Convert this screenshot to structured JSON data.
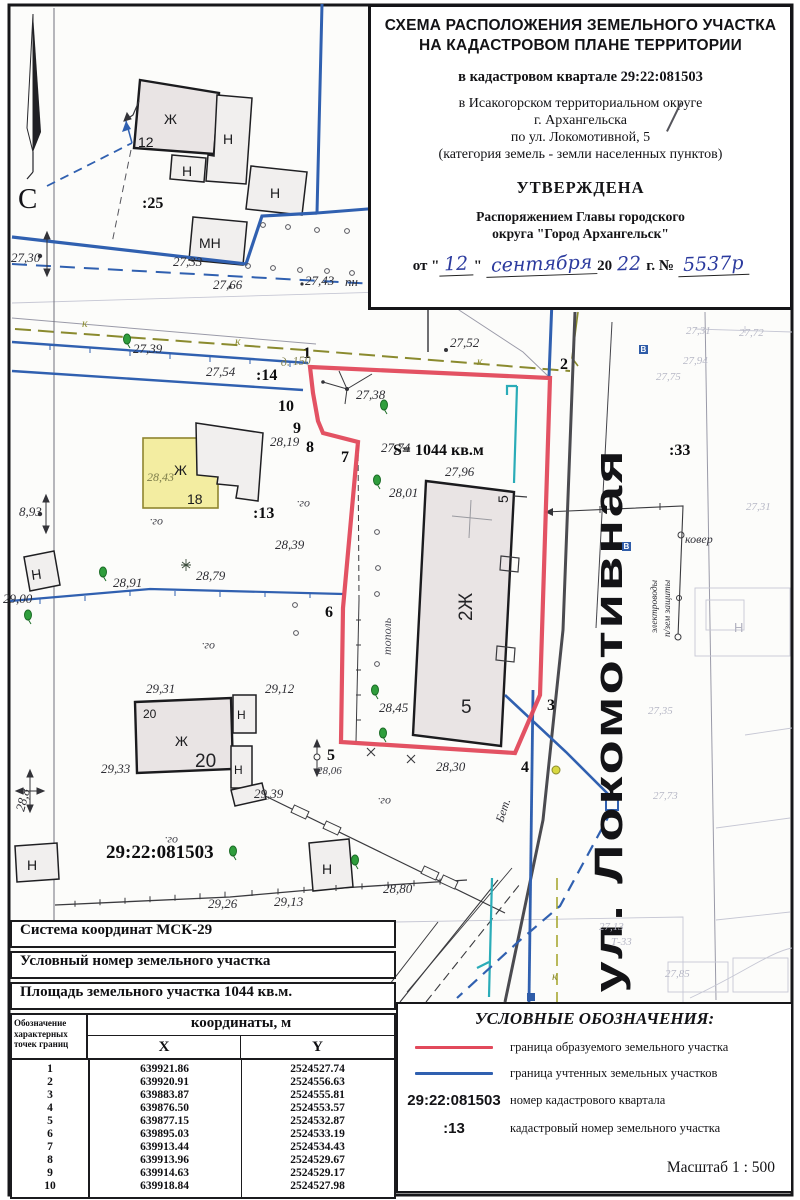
{
  "title_block": {
    "line1": "СХЕМА РАСПОЛОЖЕНИЯ ЗЕМЕЛЬНОГО УЧАСТКА",
    "line2": "НА КАДАСТРОВОМ ПЛАНЕ ТЕРРИТОРИИ",
    "quarter": "в кадастровом квартале 29:22:081503",
    "okrug": "в Исакогорском территориальном округе",
    "city": "г. Архангельска",
    "street": "по ул. Локомотивной, 5",
    "category": "(категория земель - земли населенных пунктов)",
    "approved": "УТВЕРЖДЕНА",
    "order1": "Распоряжением Главы городского",
    "order2": "округа \"Город Архангельск\"",
    "date_prefix": "от \"",
    "date_day": "12",
    "date_quote": "\"",
    "date_month": "сентября",
    "date_year_prefix": "20",
    "date_year": "22",
    "date_suffix": "г. №",
    "doc_number": "5537р"
  },
  "table": {
    "row1": "Система координат МСК-29",
    "row2": "Условный номер земельного участка",
    "row3": "Площадь земельного участка  1044 кв.м.",
    "col_point": "Обозначение характерных точек границ",
    "col_coords": "координаты, м",
    "col_x": "X",
    "col_y": "Y",
    "rows": [
      {
        "n": "1",
        "x": "639921.86",
        "y": "2524527.74"
      },
      {
        "n": "2",
        "x": "639920.91",
        "y": "2524556.63"
      },
      {
        "n": "3",
        "x": "639883.87",
        "y": "2524555.81"
      },
      {
        "n": "4",
        "x": "639876.50",
        "y": "2524553.57"
      },
      {
        "n": "5",
        "x": "639877.15",
        "y": "2524532.87"
      },
      {
        "n": "6",
        "x": "639895.03",
        "y": "2524533.19"
      },
      {
        "n": "7",
        "x": "639913.44",
        "y": "2524534.43"
      },
      {
        "n": "8",
        "x": "639913.96",
        "y": "2524529.67"
      },
      {
        "n": "9",
        "x": "639914.63",
        "y": "2524529.17"
      },
      {
        "n": "10",
        "x": "639918.84",
        "y": "2524527.98"
      }
    ]
  },
  "legend": {
    "title": "УСЛОВНЫЕ ОБОЗНАЧЕНИЯ:",
    "items": [
      {
        "symbol_type": "line",
        "color": "#e2495b",
        "label": "граница образуемого земельного участка"
      },
      {
        "symbol_type": "line",
        "color": "#3060b0",
        "label": "граница учтенных земельных участков"
      },
      {
        "symbol_type": "text",
        "symbol": "29:22:081503",
        "label": "номер кадастрового квартала"
      },
      {
        "symbol_type": "text",
        "symbol": ":13",
        "label": "кадастровый номер земельного участка"
      }
    ],
    "scale": "Масштаб  1 : 500"
  },
  "map": {
    "street_name": "ул. Локомотивная",
    "colors": {
      "boundary_new": "#e2495b",
      "boundary_existing": "#3060b0"
    },
    "labels": [
      {
        "t": "27,30",
        "x": 11,
        "y": 262,
        "c": "elev"
      },
      {
        "t": "27,33",
        "x": 173,
        "y": 266,
        "c": "elev"
      },
      {
        "t": "27,66",
        "x": 213,
        "y": 289,
        "c": "elev"
      },
      {
        "t": "27,43",
        "x": 305,
        "y": 285,
        "c": "elev"
      },
      {
        "t": "пн",
        "x": 345,
        "y": 286,
        "c": "elev"
      },
      {
        "t": "27,39",
        "x": 133,
        "y": 353,
        "c": "elev"
      },
      {
        "t": "27,54",
        "x": 206,
        "y": 376,
        "c": "elev"
      },
      {
        "t": "27,52",
        "x": 450,
        "y": 347,
        "c": "elev"
      },
      {
        "t": "27,38",
        "x": 356,
        "y": 399,
        "c": "elev"
      },
      {
        "t": "27,74",
        "x": 381,
        "y": 452,
        "c": "elev"
      },
      {
        "t": "28,01",
        "x": 389,
        "y": 497,
        "c": "elev"
      },
      {
        "t": "27,96",
        "x": 445,
        "y": 476,
        "c": "elev"
      },
      {
        "t": "28,45",
        "x": 379,
        "y": 712,
        "c": "elev"
      },
      {
        "t": "28,30",
        "x": 436,
        "y": 771,
        "c": "elev"
      },
      {
        "t": "28,19",
        "x": 270,
        "y": 446,
        "c": "elev"
      },
      {
        "t": "28,39",
        "x": 275,
        "y": 549,
        "c": "elev"
      },
      {
        "t": "28,91",
        "x": 113,
        "y": 587,
        "c": "elev"
      },
      {
        "t": "28,79",
        "x": 196,
        "y": 580,
        "c": "elev"
      },
      {
        "t": "29,00",
        "x": 3,
        "y": 603,
        "c": "elev"
      },
      {
        "t": "8,93",
        "x": 19,
        "y": 516,
        "c": "elev"
      },
      {
        "t": "29,31",
        "x": 146,
        "y": 693,
        "c": "elev"
      },
      {
        "t": "29,12",
        "x": 265,
        "y": 693,
        "c": "elev"
      },
      {
        "t": "29,33",
        "x": 101,
        "y": 773,
        "c": "elev"
      },
      {
        "t": "29,39",
        "x": 254,
        "y": 798,
        "c": "elev"
      },
      {
        "t": "29,26",
        "x": 208,
        "y": 908,
        "c": "elev"
      },
      {
        "t": "29,13",
        "x": 274,
        "y": 906,
        "c": "elev"
      },
      {
        "t": "28,80",
        "x": 383,
        "y": 893,
        "c": "elev"
      },
      {
        "t": "28,06",
        "x": 317,
        "y": 774,
        "c": "elev-sm"
      },
      {
        "t": "28,8",
        "x": 24,
        "y": 812,
        "c": "elev",
        "r": -75
      },
      {
        "t": "1",
        "x": 303,
        "y": 358,
        "c": "bold"
      },
      {
        "t": "2",
        "x": 560,
        "y": 369,
        "c": "bold"
      },
      {
        "t": "3",
        "x": 547,
        "y": 710,
        "c": "bold"
      },
      {
        "t": "4",
        "x": 521,
        "y": 772,
        "c": "bold"
      },
      {
        "t": "5",
        "x": 327,
        "y": 760,
        "c": "bold"
      },
      {
        "t": "6",
        "x": 325,
        "y": 617,
        "c": "bold"
      },
      {
        "t": "7",
        "x": 341,
        "y": 462,
        "c": "bold"
      },
      {
        "t": "8",
        "x": 306,
        "y": 452,
        "c": "bold"
      },
      {
        "t": "9",
        "x": 293,
        "y": 433,
        "c": "bold"
      },
      {
        "t": "10",
        "x": 278,
        "y": 411,
        "c": "bold"
      },
      {
        "t": ":25",
        "x": 142,
        "y": 208,
        "c": "bold"
      },
      {
        "t": ":14",
        "x": 256,
        "y": 380,
        "c": "bold"
      },
      {
        "t": ":13",
        "x": 253,
        "y": 518,
        "c": "bold"
      },
      {
        "t": ":33",
        "x": 669,
        "y": 455,
        "c": "bold"
      },
      {
        "t": "S= 1044 кв.м",
        "x": 393,
        "y": 455,
        "c": "bold"
      },
      {
        "t": "29:22:081503",
        "x": 106,
        "y": 858,
        "c": "bold-lg"
      },
      {
        "t": "Ж",
        "x": 164,
        "y": 124,
        "c": "bld"
      },
      {
        "t": "12",
        "x": 138,
        "y": 147,
        "c": "bld"
      },
      {
        "t": "Н",
        "x": 223,
        "y": 144,
        "c": "bld"
      },
      {
        "t": "Н",
        "x": 182,
        "y": 176,
        "c": "bld"
      },
      {
        "t": "Н",
        "x": 270,
        "y": 198,
        "c": "bld"
      },
      {
        "t": "МН",
        "x": 199,
        "y": 248,
        "c": "bld"
      },
      {
        "t": "Ж",
        "x": 174,
        "y": 475,
        "c": "bld"
      },
      {
        "t": "18",
        "x": 187,
        "y": 504,
        "c": "bld"
      },
      {
        "t": "Н",
        "x": 32,
        "y": 580,
        "c": "bld",
        "r": -8
      },
      {
        "t": "Ж",
        "x": 175,
        "y": 746,
        "c": "bld"
      },
      {
        "t": "20",
        "x": 143,
        "y": 718,
        "c": "bld-sm"
      },
      {
        "t": "20",
        "x": 195,
        "y": 767,
        "c": "bld-lg"
      },
      {
        "t": "Н",
        "x": 237,
        "y": 719,
        "c": "bld-sm"
      },
      {
        "t": "Н",
        "x": 234,
        "y": 774,
        "c": "bld-sm"
      },
      {
        "t": "Н",
        "x": 322,
        "y": 874,
        "c": "bld"
      },
      {
        "t": "Н",
        "x": 27,
        "y": 870,
        "c": "bld"
      },
      {
        "t": "Н",
        "x": 734,
        "y": 632,
        "c": "bld-faint"
      },
      {
        "t": "2Ж",
        "x": 472,
        "y": 621,
        "c": "bld-lg",
        "r": -90
      },
      {
        "t": "5",
        "x": 461,
        "y": 713,
        "c": "bld-lg"
      },
      {
        "t": "5",
        "x": 508,
        "y": 503,
        "c": "bld",
        "r": -90
      },
      {
        "t": "28,43",
        "x": 147,
        "y": 481,
        "c": "hand"
      },
      {
        "t": "д. 150",
        "x": 281,
        "y": 366,
        "c": "hand",
        "r": -4
      },
      {
        "t": "ог.",
        "x": 163,
        "y": 519,
        "c": "og",
        "r": 180
      },
      {
        "t": "ог.",
        "x": 215,
        "y": 643,
        "c": "og",
        "r": 180
      },
      {
        "t": "ог.",
        "x": 310,
        "y": 501,
        "c": "og",
        "r": 180
      },
      {
        "t": "ог.",
        "x": 178,
        "y": 837,
        "c": "og",
        "r": 180
      },
      {
        "t": "ог.",
        "x": 391,
        "y": 798,
        "c": "og",
        "r": 180
      },
      {
        "t": "к",
        "x": 82,
        "y": 327,
        "c": "k"
      },
      {
        "t": "к",
        "x": 235,
        "y": 345,
        "c": "k"
      },
      {
        "t": "к",
        "x": 477,
        "y": 365,
        "c": "k"
      },
      {
        "t": "к",
        "x": 552,
        "y": 980,
        "c": "k"
      },
      {
        "t": "ковер",
        "x": 685,
        "y": 543,
        "c": "tech"
      },
      {
        "t": "Бет.",
        "x": 503,
        "y": 823,
        "c": "tech",
        "r": -72
      },
      {
        "t": "тополь",
        "x": 391,
        "y": 655,
        "c": "top",
        "r": -90
      },
      {
        "t": "электроводы",
        "x": 657,
        "y": 633,
        "c": "tech-sm",
        "r": -90
      },
      {
        "t": "п/зем защиты",
        "x": 670,
        "y": 637,
        "c": "tech-sm",
        "r": -90
      },
      {
        "t": "27,31",
        "x": 686,
        "y": 334,
        "c": "faint"
      },
      {
        "t": "27,72",
        "x": 739,
        "y": 336,
        "c": "faint"
      },
      {
        "t": "27,94",
        "x": 683,
        "y": 364,
        "c": "faint"
      },
      {
        "t": "27,75",
        "x": 656,
        "y": 380,
        "c": "faint"
      },
      {
        "t": "27,35",
        "x": 648,
        "y": 714,
        "c": "faint"
      },
      {
        "t": "27,73",
        "x": 653,
        "y": 799,
        "c": "faint"
      },
      {
        "t": "27,13",
        "x": 599,
        "y": 930,
        "c": "faint"
      },
      {
        "t": "Т-33",
        "x": 611,
        "y": 945,
        "c": "faint"
      },
      {
        "t": "27,85",
        "x": 665,
        "y": 977,
        "c": "faint"
      },
      {
        "t": "27,31",
        "x": 746,
        "y": 510,
        "c": "faint"
      },
      {
        "t": "С",
        "x": 18,
        "y": 208,
        "c": "north"
      },
      {
        "t": "В",
        "x": 640.5,
        "y": 352,
        "c": "wletter"
      },
      {
        "t": "В",
        "x": 623.5,
        "y": 549,
        "c": "wletter"
      }
    ],
    "trees": [
      [
        384,
        405
      ],
      [
        377,
        480
      ],
      [
        375,
        690
      ],
      [
        383,
        733
      ],
      [
        103,
        572
      ],
      [
        28,
        615
      ],
      [
        127,
        339
      ],
      [
        233,
        851
      ],
      [
        355,
        860
      ]
    ],
    "star_trees": [
      [
        186,
        565
      ]
    ],
    "circles": [
      [
        263,
        225
      ],
      [
        288,
        227
      ],
      [
        317,
        230
      ],
      [
        347,
        231
      ],
      [
        248,
        266
      ],
      [
        273,
        268
      ],
      [
        300,
        270
      ],
      [
        327,
        271
      ],
      [
        352,
        273
      ],
      [
        377,
        532
      ],
      [
        378,
        568
      ],
      [
        377,
        594
      ],
      [
        295,
        605
      ],
      [
        296,
        633
      ],
      [
        377,
        664
      ]
    ]
  }
}
